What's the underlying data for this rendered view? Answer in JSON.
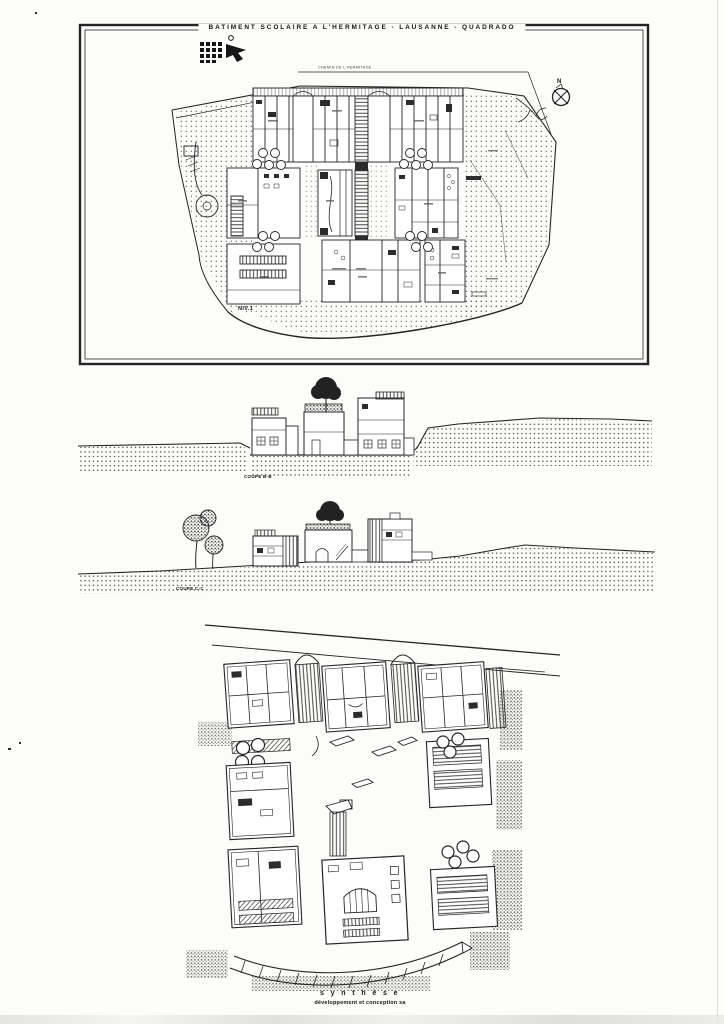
{
  "colors": {
    "paper": "#fcfcfa",
    "ink": "#242424"
  },
  "plan": {
    "title": "BATIMENT SCOLAIRE A L'HERMITAGE - LAUSANNE - QUADRADO",
    "road_label": "CHEMIN DE L'HERMITAGE",
    "level_label": "NIV.1",
    "north_label": "N"
  },
  "sections": [
    {
      "label": "COUPE B-B"
    },
    {
      "label": "COUPE C-C"
    }
  ],
  "axon": {
    "caption": "s y n t h è s e",
    "subcaption": "développement et conception  sa"
  }
}
